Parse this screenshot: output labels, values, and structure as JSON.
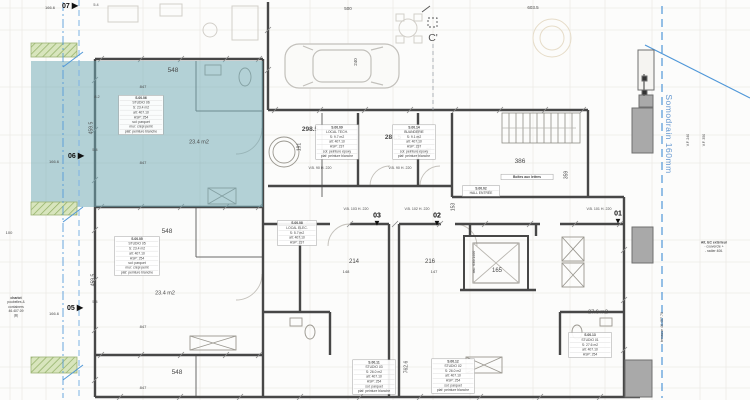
{
  "plan": {
    "section_marker": "C'",
    "drain_label": "Somodrain 160mm",
    "colors": {
      "highlight_teal": "#6fa9b5",
      "accent_blue": "#4f97d8",
      "drain_text_blue": "#4a86c8",
      "planter_green": "#d8e5bd",
      "planter_hatch_green": "#8fae63"
    },
    "labels": [
      {
        "t": "548",
        "x": 173,
        "y": 71,
        "s": 6.5
      },
      {
        "t": "548",
        "x": 167,
        "y": 232,
        "s": 6.5
      },
      {
        "t": "548",
        "x": 177,
        "y": 373,
        "s": 6.5
      },
      {
        "t": "23.4 m2",
        "x": 199,
        "y": 142,
        "s": 5.5
      },
      {
        "t": "23.4 m2",
        "x": 165,
        "y": 293,
        "s": 5.5
      },
      {
        "t": "298.5",
        "x": 310,
        "y": 130,
        "s": 6.5,
        "b": 1
      },
      {
        "t": "281.5",
        "x": 393,
        "y": 138,
        "s": 6.5,
        "b": 1
      },
      {
        "t": "191",
        "x": 299,
        "y": 147,
        "s": 5,
        "r": -90
      },
      {
        "t": "191",
        "x": 429,
        "y": 151,
        "s": 5,
        "r": -90
      },
      {
        "t": "386",
        "x": 520,
        "y": 162,
        "s": 6.5
      },
      {
        "t": "359",
        "x": 566,
        "y": 175,
        "s": 5,
        "r": -90
      },
      {
        "t": "153",
        "x": 453,
        "y": 207,
        "s": 5,
        "r": -90
      },
      {
        "t": "214",
        "x": 354,
        "y": 262,
        "s": 6
      },
      {
        "t": "216",
        "x": 430,
        "y": 262,
        "s": 6
      },
      {
        "t": "165",
        "x": 497,
        "y": 271,
        "s": 6
      },
      {
        "t": "27.6 m2",
        "x": 598,
        "y": 312,
        "s": 5.5
      },
      {
        "t": "762.6",
        "x": 406,
        "y": 367,
        "s": 5,
        "r": -90
      },
      {
        "t": "459.5",
        "x": 91,
        "y": 128,
        "s": 5,
        "r": -90
      },
      {
        "t": "459.5",
        "x": 93,
        "y": 280,
        "s": 5,
        "r": -90
      },
      {
        "t": "847",
        "x": 143,
        "y": 87,
        "s": 4
      },
      {
        "t": "847",
        "x": 143,
        "y": 163,
        "s": 4
      },
      {
        "t": "847",
        "x": 143,
        "y": 240,
        "s": 4
      },
      {
        "t": "847",
        "x": 143,
        "y": 327,
        "s": 4
      },
      {
        "t": "847",
        "x": 143,
        "y": 388,
        "s": 4
      },
      {
        "t": "603.5",
        "x": 533,
        "y": 8,
        "s": 4.5
      },
      {
        "t": "500",
        "x": 348,
        "y": 9,
        "s": 4.5
      },
      {
        "t": "240",
        "x": 356,
        "y": 62,
        "s": 4.5,
        "r": -90
      },
      {
        "t": "166.6",
        "x": 50,
        "y": 8,
        "s": 4
      },
      {
        "t": "166.6",
        "x": 54,
        "y": 162,
        "s": 4
      },
      {
        "t": "166.6",
        "x": 54,
        "y": 314,
        "s": 4
      },
      {
        "t": "5.4",
        "x": 96,
        "y": 5,
        "s": 3.8
      },
      {
        "t": "5.4",
        "x": 95,
        "y": 150,
        "s": 3.8
      },
      {
        "t": "5.4",
        "x": 95,
        "y": 302,
        "s": 3.8
      },
      {
        "t": "8.2",
        "x": 97,
        "y": 97,
        "s": 3.8
      },
      {
        "t": "100",
        "x": 9,
        "y": 233,
        "s": 4
      },
      {
        "t": "148",
        "x": 346,
        "y": 272,
        "s": 4
      },
      {
        "t": "147",
        "x": 434,
        "y": 272,
        "s": 4
      },
      {
        "t": "V.B. 90  H. 220",
        "x": 320,
        "y": 168,
        "s": 3.6
      },
      {
        "t": "V.B. 90  H. 220",
        "x": 400,
        "y": 168,
        "s": 3.6
      },
      {
        "t": "V.B. 103  H. 220",
        "x": 356,
        "y": 209,
        "s": 3.6
      },
      {
        "t": "V.B. 102  H. 220",
        "x": 417,
        "y": 209,
        "s": 3.6
      },
      {
        "t": "V.B. 101  H. 220",
        "x": 599,
        "y": 209,
        "s": 3.6
      },
      {
        "t": "asc. 630/1400",
        "x": 474,
        "y": 262,
        "s": 3.6,
        "r": -90
      },
      {
        "t": "terrasse  46.457.70",
        "x": 662,
        "y": 327,
        "s": 3.6,
        "r": -90
      },
      {
        "t": "V.F. 240",
        "x": 688,
        "y": 140,
        "s": 3.5,
        "r": -90
      },
      {
        "t": "V.F. 350",
        "x": 704,
        "y": 140,
        "s": 3.5,
        "r": -90
      }
    ],
    "mailbox_block": {
      "x": 527,
      "y": 177,
      "w": 54,
      "lines": [
        "Boîtes aux lettres"
      ]
    },
    "blocks": [
      {
        "x": 141,
        "y": 115,
        "w": 46,
        "lines": [
          "S.00.06",
          "STUDIO 06",
          "S: 23.4 m2",
          "alt: 407.10",
          "HSP: 254",
          "sol: parquet",
          "mur: crépi peint",
          "plaf: peinture blanche"
        ]
      },
      {
        "x": 137,
        "y": 256,
        "w": 46,
        "lines": [
          "S.00.05",
          "STUDIO 05",
          "S: 23.4 m2",
          "alt: 407.10",
          "HSP: 254",
          "sol: parquet",
          "mur: crépi peint",
          "plaf: peinture blanche"
        ]
      },
      {
        "x": 337,
        "y": 142,
        "w": 44,
        "lines": [
          "S.00.09",
          "LOCAL TECH.",
          "S: 9.7 m2",
          "alt: 407.10",
          "HSP: 237",
          "sol: peinture époxy",
          "plaf: peinture blanche"
        ]
      },
      {
        "x": 414,
        "y": 142,
        "w": 44,
        "lines": [
          "S.00.14",
          "BUANDERIE",
          "S: 9.1 m2",
          "alt: 407.10",
          "HSP: 237",
          "sol: peinture époxy",
          "plaf: peinture blanche"
        ]
      },
      {
        "x": 297,
        "y": 233,
        "w": 40,
        "lines": [
          "S.00.08",
          "LOCAL ELEC.",
          "S: 5.7 m2",
          "alt: 407.10",
          "HSP: 237"
        ]
      },
      {
        "x": 374,
        "y": 377,
        "w": 44,
        "lines": [
          "S.00.11",
          "STUDIO 03",
          "S: 26.0 m2",
          "alt: 407.10",
          "HSP: 254",
          "sol: parquet",
          "plaf: peinture blanche"
        ]
      },
      {
        "x": 453,
        "y": 376,
        "w": 44,
        "lines": [
          "S.00.12",
          "STUDIO 02",
          "S: 26.0 m2",
          "alt: 407.10",
          "HSP: 254",
          "sol: parquet",
          "plaf: peinture blanche"
        ]
      },
      {
        "x": 590,
        "y": 345,
        "w": 44,
        "lines": [
          "S.00.13",
          "STUDIO 01",
          "S: 27.6 m2",
          "alt: 407.10",
          "HSP: 254"
        ]
      },
      {
        "x": 481,
        "y": 191,
        "w": 38,
        "lines": [
          "S.00.02",
          "HALL ENTRÉE"
        ]
      },
      {
        "x": 16,
        "y": 307,
        "w": 34,
        "border": false,
        "lines": [
          "chariot",
          "poubelles &",
          "containers",
          "46.407.09",
          "(B)"
        ]
      },
      {
        "x": 714,
        "y": 247,
        "w": 44,
        "border": false,
        "lines": [
          "Alt. EC extérieur",
          "- couvercle +",
          "- radier 406."
        ]
      }
    ],
    "markers": [
      {
        "label": "07",
        "x": 70,
        "y": 6,
        "dir": "right"
      },
      {
        "label": "06",
        "x": 76,
        "y": 156,
        "dir": "right"
      },
      {
        "label": "05",
        "x": 75,
        "y": 308,
        "dir": "right"
      },
      {
        "label": "03",
        "x": 377,
        "y": 220,
        "dir": "down"
      },
      {
        "label": "02",
        "x": 437,
        "y": 220,
        "dir": "down"
      },
      {
        "label": "01",
        "x": 618,
        "y": 218,
        "dir": "down"
      }
    ]
  }
}
